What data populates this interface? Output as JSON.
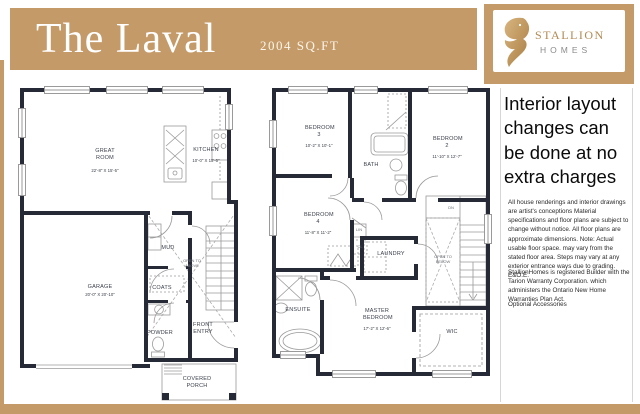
{
  "header": {
    "title": "The Laval",
    "sqft": "2004 SQ.FT"
  },
  "logo": {
    "brand": "STALLION",
    "sub": "HOMES"
  },
  "right_column": {
    "promo": "Interior layout changes can be done at no extra charges",
    "disclaimer1": "All house renderings and interior drawings are artist's conceptions Material specifications and floor plans are subject to change without notice. All floor plans are approximate dimensions. Note: Actual usable floor space. may vary from the stated floor area. Steps may vary at any exterior entrance ways due to grading. E&O.E.",
    "disclaimer2": "StallionHomes is registered Builder with the Tarion Warranty Corporation. which administers the Ontario New Home Warranties Plan Act.",
    "disclaimer3": "Optional Accessories"
  },
  "floor1": {
    "great_room": {
      "name": "GREAT ROOM",
      "dims": "22'-8\" X 15'-5\""
    },
    "kitchen": {
      "name": "KITCHEN",
      "dims": "10'-0\" X 15'-5\""
    },
    "garage": {
      "name": "GARAGE",
      "dims": "20'-0\" X 20'-10\""
    },
    "mud": "MUD",
    "coats": "COATS",
    "powder": "POWDER",
    "front_entry": "FRONT ENTRY",
    "covered_porch": "COVERED PORCH",
    "open_above": "OPEN TO ABOVE"
  },
  "floor2": {
    "bedroom3": {
      "name": "BEDROOM 3",
      "dims": "10'-2\" X 10'-1\""
    },
    "bedroom2": {
      "name": "BEDROOM 2",
      "dims": "11'-10\" X 12'-7\""
    },
    "bedroom4": {
      "name": "BEDROOM 4",
      "dims": "11'-8\" X 11'-2\""
    },
    "master": {
      "name": "MASTER BEDROOM",
      "dims": "17'-2\" X 12'-6\""
    },
    "bath": "BATH",
    "lin": "LIN",
    "cl": "CL",
    "laundry": "LAUNDRY",
    "ensuite": "ENSUITE",
    "wic": "WIC",
    "dn": "DN",
    "open_below": "OPEN TO BELOW"
  },
  "colors": {
    "tan": "#c49a69",
    "wall": "#262a36",
    "thin_line": "#9a9a9a",
    "brand_text": "#b28a52",
    "homes_text": "#8b8b8b"
  }
}
